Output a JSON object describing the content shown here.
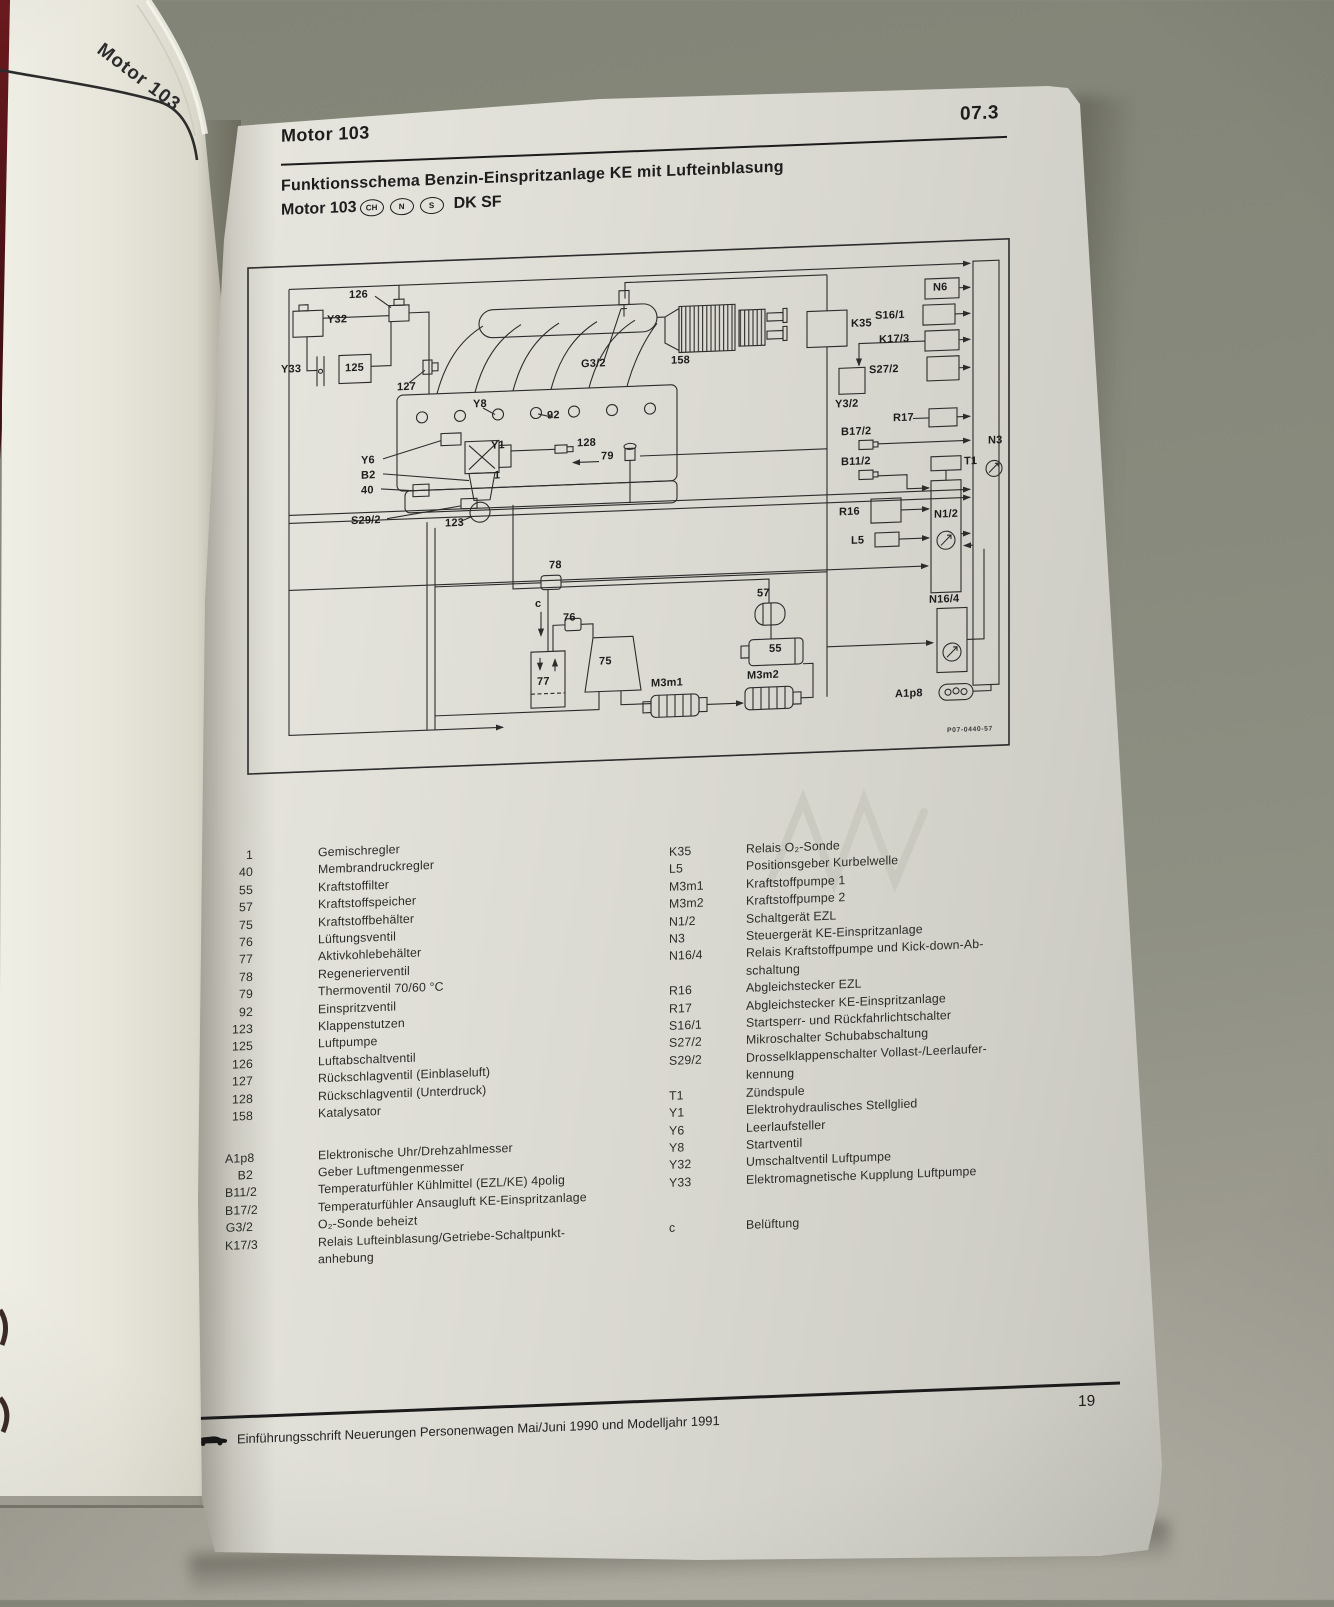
{
  "photo": {
    "spine_label": "Motor 103",
    "background_color": "#8b8d80",
    "cover_color": "#4c1215",
    "page_color": "#ddece1"
  },
  "page": {
    "header": {
      "section": "Motor 103",
      "code": "07.3"
    },
    "title": {
      "line1": "Funktionsschema Benzin-Einspritzanlage KE mit Lufteinblasung",
      "line2_prefix": "Motor 103",
      "badges": [
        "CH",
        "N",
        "S"
      ],
      "line2_suffix": "DK SF"
    },
    "footer": {
      "text": "Einführungsschrift Neuerungen Personenwagen Mai/Juni 1990 und Modelljahr 1991",
      "page_number": "19"
    }
  },
  "diagram": {
    "drawing_number": "P07-0440-57",
    "labels": [
      {
        "t": "126",
        "x": 102,
        "y": 26
      },
      {
        "t": "Y32",
        "x": 80,
        "y": 50
      },
      {
        "t": "Y33",
        "x": 34,
        "y": 98
      },
      {
        "t": "125",
        "x": 98,
        "y": 99
      },
      {
        "t": "127",
        "x": 150,
        "y": 120
      },
      {
        "t": "Y8",
        "x": 226,
        "y": 140
      },
      {
        "t": "92",
        "x": 300,
        "y": 154
      },
      {
        "t": "Y1",
        "x": 244,
        "y": 182
      },
      {
        "t": "1",
        "x": 247,
        "y": 212
      },
      {
        "t": "128",
        "x": 330,
        "y": 183
      },
      {
        "t": "79",
        "x": 354,
        "y": 197
      },
      {
        "t": "Y6",
        "x": 114,
        "y": 192
      },
      {
        "t": "B2",
        "x": 114,
        "y": 207
      },
      {
        "t": "40",
        "x": 114,
        "y": 222
      },
      {
        "t": "S29/2",
        "x": 104,
        "y": 252
      },
      {
        "t": "123",
        "x": 198,
        "y": 258
      },
      {
        "t": "G3/2",
        "x": 334,
        "y": 104
      },
      {
        "t": "158",
        "x": 424,
        "y": 104
      },
      {
        "t": "K35",
        "x": 604,
        "y": 74
      },
      {
        "t": "N6",
        "x": 686,
        "y": 41
      },
      {
        "t": "S16/1",
        "x": 628,
        "y": 67
      },
      {
        "t": "K17/3",
        "x": 632,
        "y": 91
      },
      {
        "t": "S27/2",
        "x": 622,
        "y": 121
      },
      {
        "t": "Y3/2",
        "x": 588,
        "y": 154
      },
      {
        "t": "R17",
        "x": 646,
        "y": 170
      },
      {
        "t": "B17/2",
        "x": 594,
        "y": 182
      },
      {
        "t": "B11/2",
        "x": 594,
        "y": 212
      },
      {
        "t": "T1",
        "x": 717,
        "y": 216
      },
      {
        "t": "N3",
        "x": 741,
        "y": 196
      },
      {
        "t": "R16",
        "x": 592,
        "y": 262
      },
      {
        "t": "L5",
        "x": 604,
        "y": 291
      },
      {
        "t": "N1/2",
        "x": 687,
        "y": 268
      },
      {
        "t": "N16/4",
        "x": 682,
        "y": 353
      },
      {
        "t": "A1p8",
        "x": 648,
        "y": 446
      },
      {
        "t": "78",
        "x": 302,
        "y": 304
      },
      {
        "t": "c",
        "x": 288,
        "y": 342
      },
      {
        "t": "76",
        "x": 316,
        "y": 357
      },
      {
        "t": "77",
        "x": 290,
        "y": 420
      },
      {
        "t": "75",
        "x": 352,
        "y": 402
      },
      {
        "t": "57",
        "x": 510,
        "y": 340
      },
      {
        "t": "55",
        "x": 522,
        "y": 396
      },
      {
        "t": "M3m1",
        "x": 404,
        "y": 426
      },
      {
        "t": "M3m2",
        "x": 500,
        "y": 422
      }
    ]
  },
  "legend": {
    "left_groups": [
      [
        [
          "1",
          "Gemischregler"
        ],
        [
          "40",
          "Membrandruckregler"
        ],
        [
          "55",
          "Kraftstoffilter"
        ],
        [
          "57",
          "Kraftstoffspeicher"
        ],
        [
          "75",
          "Kraftstoffbehälter"
        ],
        [
          "76",
          "Lüftungsventil"
        ],
        [
          "77",
          "Aktivkohlebehälter"
        ],
        [
          "78",
          "Regenerierventil"
        ],
        [
          "79",
          "Thermoventil 70/60 °C"
        ],
        [
          "92",
          "Einspritzventil"
        ],
        [
          "123",
          "Klappenstutzen"
        ],
        [
          "125",
          "Luftpumpe"
        ],
        [
          "126",
          "Luftabschaltventil"
        ],
        [
          "127",
          "Rückschlagventil (Einblaseluft)"
        ],
        [
          "128",
          "Rückschlagventil (Unterdruck)"
        ],
        [
          "158",
          "Katalysator"
        ]
      ],
      [
        [
          "A1p8",
          "Elektronische Uhr/Drehzahlmesser"
        ],
        [
          "B2",
          "Geber Luftmengenmesser"
        ],
        [
          "B11/2",
          "Temperaturfühler Kühlmittel (EZL/KE) 4polig"
        ],
        [
          "B17/2",
          "Temperaturfühler Ansaugluft KE-Einspritzanlage"
        ],
        [
          "G3/2",
          "O₂-Sonde beheizt"
        ],
        [
          "K17/3",
          "Relais Lufteinblasung/Getriebe-Schaltpunkt-\nanhebung"
        ]
      ]
    ],
    "right_groups": [
      [
        [
          "K35",
          "Relais O₂-Sonde"
        ],
        [
          "L5",
          "Positionsgeber Kurbelwelle"
        ],
        [
          "M3m1",
          "Kraftstoffpumpe 1"
        ],
        [
          "M3m2",
          "Kraftstoffpumpe 2"
        ],
        [
          "N1/2",
          "Schaltgerät EZL"
        ],
        [
          "N3",
          "Steuergerät KE-Einspritzanlage"
        ],
        [
          "N16/4",
          "Relais Kraftstoffpumpe und Kick-down-Ab-\nschaltung"
        ],
        [
          "R16",
          "Abgleichstecker EZL"
        ],
        [
          "R17",
          "Abgleichstecker KE-Einspritzanlage"
        ],
        [
          "S16/1",
          "Startsperr- und Rückfahrlichtschalter"
        ],
        [
          "S27/2",
          "Mikroschalter Schubabschaltung"
        ],
        [
          "S29/2",
          "Drosselklappenschalter Vollast-/Leerlaufer-\nkennung"
        ],
        [
          "T1",
          "Zündspule"
        ],
        [
          "Y1",
          "Elektrohydraulisches Stellglied"
        ],
        [
          "Y6",
          "Leerlaufsteller"
        ],
        [
          "Y8",
          "Startventil"
        ],
        [
          "Y32",
          "Umschaltventil Luftpumpe"
        ],
        [
          "Y33",
          "Elektromagnetische Kupplung Luftpumpe"
        ]
      ],
      [
        [
          "c",
          "Belüftung"
        ]
      ]
    ]
  }
}
